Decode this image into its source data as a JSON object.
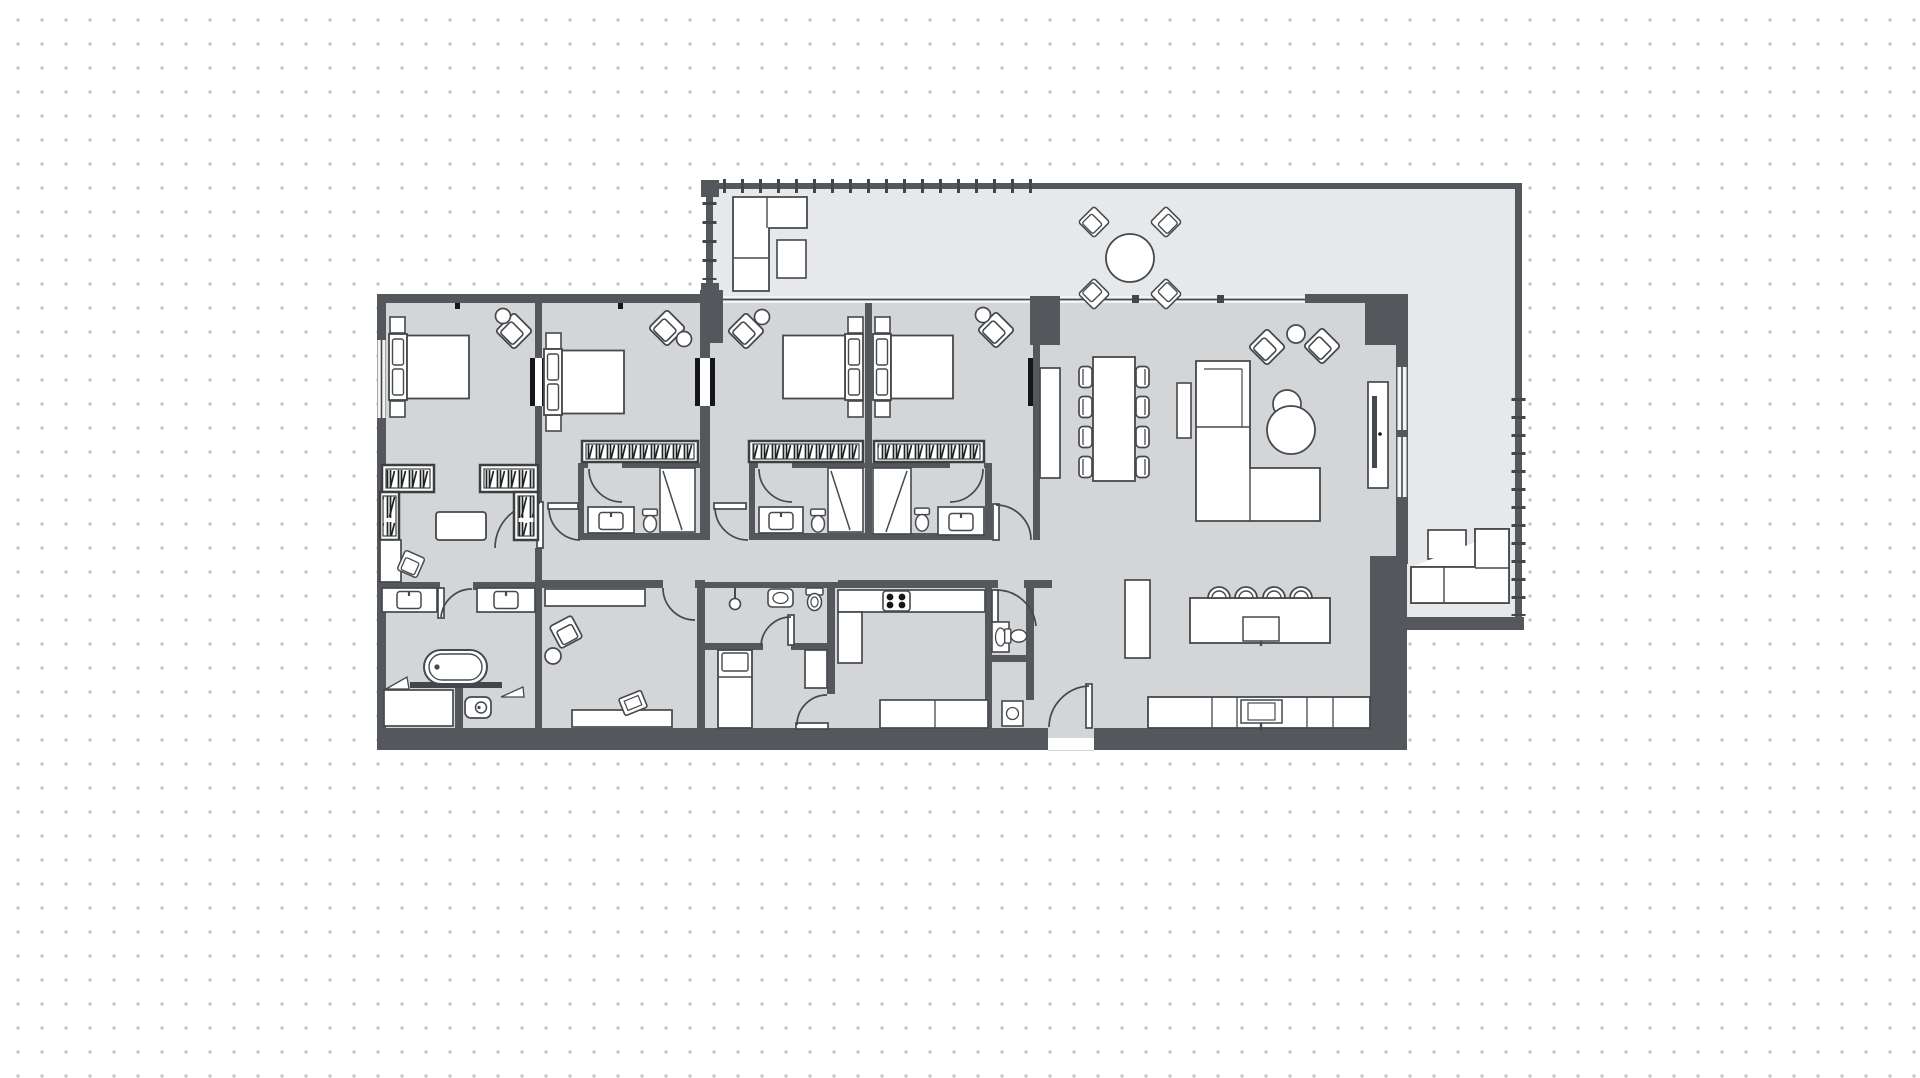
{
  "meta": {
    "content_type": "architectural-floor-plan",
    "view": "2d-top-down",
    "text_labels": []
  },
  "colors": {
    "background": "#ffffff",
    "dot_grid": "#c8c9ca",
    "wall": "#54585d",
    "wall_dark": "#43474b",
    "floor_interior": "#d3d5d7",
    "floor_terrace": "#e6e8e9",
    "furniture_fill": "#ffffff",
    "furniture_stroke": "#45494d",
    "hatch": "#1f2123",
    "black_jamb": "#141619"
  },
  "grid": {
    "pitch_px": 24,
    "dot_diameter_px": 3.4
  },
  "plan": {
    "summary": {
      "bedrooms": 4,
      "bathrooms": 5,
      "terraces": 2,
      "kitchen": 1,
      "living_dining": 1,
      "study": 1,
      "maid_room": 1,
      "dressing_room": 1
    },
    "rooms": [
      {
        "id": "master-bedroom",
        "furniture": [
          "double-bed",
          "nightstand",
          "nightstand",
          "armchair",
          "side-table",
          "window"
        ]
      },
      {
        "id": "master-dressing",
        "furniture": [
          "wardrobe-hatched",
          "wardrobe-hatched",
          "ottoman",
          "cabinet",
          "armchair"
        ]
      },
      {
        "id": "master-bathroom",
        "furniture": [
          "double-vanity",
          "bathtub",
          "shower",
          "toilet"
        ]
      },
      {
        "id": "bedroom-2",
        "furniture": [
          "double-bed",
          "nightstand",
          "nightstand",
          "armchair",
          "side-table",
          "wardrobe-hatched"
        ]
      },
      {
        "id": "bathroom-2",
        "furniture": [
          "vanity-sink",
          "toilet",
          "shower"
        ]
      },
      {
        "id": "bedroom-3",
        "furniture": [
          "double-bed",
          "nightstand",
          "nightstand",
          "armchair",
          "side-table",
          "wardrobe-hatched"
        ]
      },
      {
        "id": "bathroom-3",
        "furniture": [
          "vanity-sink",
          "toilet",
          "shower"
        ]
      },
      {
        "id": "bedroom-4",
        "furniture": [
          "double-bed",
          "nightstand",
          "nightstand",
          "armchair",
          "side-table",
          "wardrobe-hatched"
        ]
      },
      {
        "id": "bathroom-4",
        "furniture": [
          "vanity-sink",
          "toilet",
          "shower"
        ]
      },
      {
        "id": "study",
        "furniture": [
          "desk",
          "armchair",
          "side-table",
          "console",
          "tv"
        ]
      },
      {
        "id": "maid-room",
        "furniture": [
          "single-bed",
          "wardrobe-cabinet"
        ]
      },
      {
        "id": "maid-bathroom",
        "furniture": [
          "shower-head",
          "wash-basin",
          "toilet"
        ]
      },
      {
        "id": "powder-room",
        "furniture": [
          "wash-basin",
          "toilet"
        ]
      },
      {
        "id": "laundry-storage",
        "furniture": [
          "washing-machine"
        ]
      },
      {
        "id": "kitchen",
        "furniture": [
          "hob-4-burner",
          "counter",
          "tall-cabinet",
          "island-with-sink",
          "bar-stool-x4",
          "counter-with-sink"
        ]
      },
      {
        "id": "living-dining",
        "furniture": [
          "sideboard",
          "dining-table-8-chairs",
          "l-shaped-sofa",
          "side-table",
          "coffee-tables",
          "armchair",
          "armchair",
          "round-table",
          "tv-console"
        ]
      },
      {
        "id": "terrace-top",
        "furniture": [
          "l-shaped-sofa",
          "side-table",
          "round-dining-table-4-chairs",
          "railing"
        ]
      },
      {
        "id": "terrace-right",
        "furniture": [
          "l-shaped-sofa",
          "square-table",
          "railing"
        ]
      },
      {
        "id": "entry",
        "furniture": [
          "entrance-door"
        ]
      }
    ]
  }
}
